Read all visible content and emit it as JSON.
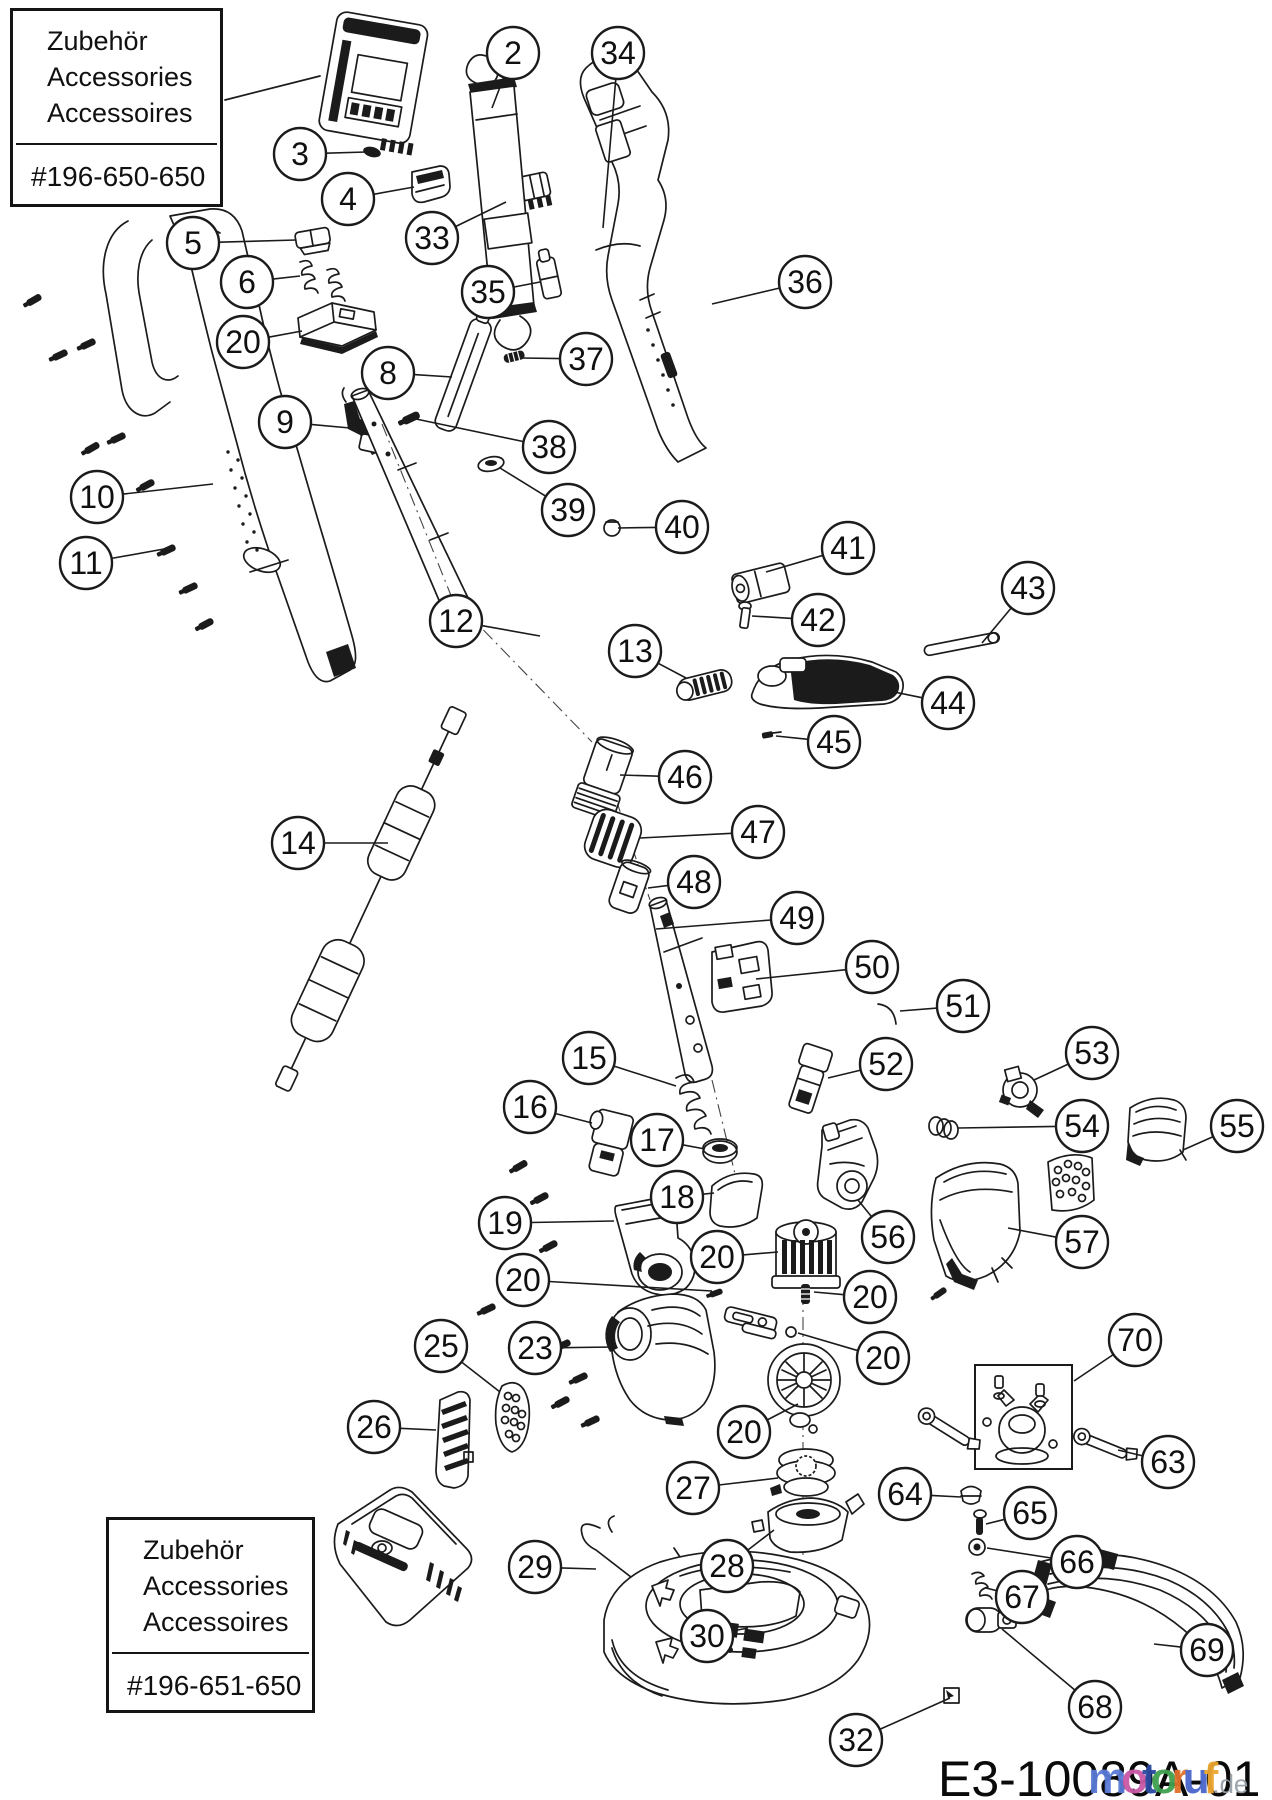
{
  "page": {
    "background": "#ffffff",
    "ink": "#1b1b1b"
  },
  "accessory_boxes": [
    {
      "lines": [
        "Zubehör",
        "Accessories",
        "Accessoires"
      ],
      "part_number": "#196-650-650"
    },
    {
      "lines": [
        "Zubehör",
        "Accessories",
        "Accessoires"
      ],
      "part_number": "#196-651-650"
    }
  ],
  "footer": {
    "drawing_number": "E3-10089A-01"
  },
  "watermark": {
    "suffix": ".de",
    "letters": [
      {
        "ch": "m",
        "color": "#5a7bd8"
      },
      {
        "ch": "o",
        "color": "#c957a5"
      },
      {
        "ch": "t",
        "color": "#2b4aa0"
      },
      {
        "ch": "o",
        "color": "#3fa04f"
      },
      {
        "ch": "r",
        "color": "#e2702a"
      },
      {
        "ch": "u",
        "color": "#4a66cc"
      },
      {
        "ch": "f",
        "color": "#eda52f"
      }
    ]
  },
  "callouts": [
    {
      "n": "2",
      "x": 513,
      "y": 53,
      "tx": 492,
      "ty": 108
    },
    {
      "n": "34",
      "x": 618,
      "y": 53,
      "tx": 603,
      "ty": 228
    },
    {
      "n": "3",
      "x": 300,
      "y": 154,
      "tx": 366,
      "ty": 152
    },
    {
      "n": "4",
      "x": 348,
      "y": 199,
      "tx": 414,
      "ty": 187
    },
    {
      "n": "33",
      "x": 432,
      "y": 238,
      "tx": 506,
      "ty": 202
    },
    {
      "n": "5",
      "x": 193,
      "y": 243,
      "tx": 296,
      "ty": 240
    },
    {
      "n": "6",
      "x": 247,
      "y": 282,
      "tx": 300,
      "ty": 276
    },
    {
      "n": "35",
      "x": 488,
      "y": 292,
      "tx": 540,
      "ty": 282
    },
    {
      "n": "36",
      "x": 805,
      "y": 282,
      "tx": 712,
      "ty": 304
    },
    {
      "n": "20",
      "x": 243,
      "y": 342,
      "tx": 302,
      "ty": 331
    },
    {
      "n": "8",
      "x": 388,
      "y": 373,
      "tx": 452,
      "ty": 377
    },
    {
      "n": "37",
      "x": 586,
      "y": 359,
      "tx": 522,
      "ty": 358
    },
    {
      "n": "9",
      "x": 285,
      "y": 422,
      "tx": 350,
      "ty": 428
    },
    {
      "n": "38",
      "x": 549,
      "y": 447,
      "tx": 416,
      "ty": 419
    },
    {
      "n": "10",
      "x": 97,
      "y": 497,
      "tx": 213,
      "ty": 484
    },
    {
      "n": "39",
      "x": 568,
      "y": 510,
      "tx": 500,
      "ty": 468
    },
    {
      "n": "40",
      "x": 682,
      "y": 527,
      "tx": 618,
      "ty": 528
    },
    {
      "n": "11",
      "x": 86,
      "y": 563,
      "tx": 164,
      "ty": 549
    },
    {
      "n": "41",
      "x": 848,
      "y": 548,
      "tx": 766,
      "ty": 572
    },
    {
      "n": "43",
      "x": 1028,
      "y": 588,
      "tx": 982,
      "ty": 643
    },
    {
      "n": "12",
      "x": 456,
      "y": 621,
      "tx": 540,
      "ty": 636
    },
    {
      "n": "42",
      "x": 818,
      "y": 620,
      "tx": 752,
      "ty": 616
    },
    {
      "n": "13",
      "x": 635,
      "y": 651,
      "tx": 686,
      "ty": 678
    },
    {
      "n": "44",
      "x": 948,
      "y": 703,
      "tx": 870,
      "ty": 687
    },
    {
      "n": "45",
      "x": 834,
      "y": 742,
      "tx": 776,
      "ty": 736
    },
    {
      "n": "46",
      "x": 685,
      "y": 777,
      "tx": 620,
      "ty": 775
    },
    {
      "n": "14",
      "x": 298,
      "y": 843,
      "tx": 388,
      "ty": 843
    },
    {
      "n": "47",
      "x": 758,
      "y": 832,
      "tx": 640,
      "ty": 838
    },
    {
      "n": "48",
      "x": 694,
      "y": 882,
      "tx": 648,
      "ty": 888
    },
    {
      "n": "49",
      "x": 797,
      "y": 918,
      "tx": 656,
      "ty": 929
    },
    {
      "n": "50",
      "x": 872,
      "y": 967,
      "tx": 756,
      "ty": 979
    },
    {
      "n": "51",
      "x": 963,
      "y": 1006,
      "tx": 900,
      "ty": 1011
    },
    {
      "n": "53",
      "x": 1092,
      "y": 1053,
      "tx": 1034,
      "ty": 1080
    },
    {
      "n": "15",
      "x": 589,
      "y": 1058,
      "tx": 676,
      "ty": 1086
    },
    {
      "n": "52",
      "x": 886,
      "y": 1064,
      "tx": 828,
      "ty": 1078
    },
    {
      "n": "16",
      "x": 530,
      "y": 1107,
      "tx": 592,
      "ty": 1123
    },
    {
      "n": "54",
      "x": 1082,
      "y": 1126,
      "tx": 958,
      "ty": 1128
    },
    {
      "n": "55",
      "x": 1237,
      "y": 1126,
      "tx": 1183,
      "ty": 1150
    },
    {
      "n": "17",
      "x": 657,
      "y": 1140,
      "tx": 705,
      "ty": 1149
    },
    {
      "n": "18",
      "x": 677,
      "y": 1197,
      "tx": 714,
      "ty": 1193
    },
    {
      "n": "19",
      "x": 505,
      "y": 1223,
      "tx": 614,
      "ty": 1221
    },
    {
      "n": "56",
      "x": 888,
      "y": 1237,
      "tx": 858,
      "ty": 1200
    },
    {
      "n": "57",
      "x": 1082,
      "y": 1242,
      "tx": 1008,
      "ty": 1228
    },
    {
      "n": "20",
      "x": 717,
      "y": 1257,
      "tx": 778,
      "ty": 1252
    },
    {
      "n": "20",
      "x": 523,
      "y": 1280,
      "tx": 712,
      "ty": 1291
    },
    {
      "n": "20",
      "x": 870,
      "y": 1297,
      "tx": 814,
      "ty": 1292
    },
    {
      "n": "70",
      "x": 1135,
      "y": 1340,
      "tx": 1074,
      "ty": 1381
    },
    {
      "n": "25",
      "x": 441,
      "y": 1346,
      "tx": 500,
      "ty": 1392
    },
    {
      "n": "23",
      "x": 535,
      "y": 1348,
      "tx": 614,
      "ty": 1347
    },
    {
      "n": "20",
      "x": 883,
      "y": 1358,
      "tx": 798,
      "ty": 1333
    },
    {
      "n": "26",
      "x": 374,
      "y": 1427,
      "tx": 436,
      "ty": 1430
    },
    {
      "n": "20",
      "x": 744,
      "y": 1432,
      "tx": 798,
      "ty": 1404
    },
    {
      "n": "63",
      "x": 1168,
      "y": 1462,
      "tx": 1118,
      "ty": 1450
    },
    {
      "n": "27",
      "x": 693,
      "y": 1488,
      "tx": 778,
      "ty": 1478
    },
    {
      "n": "64",
      "x": 905,
      "y": 1494,
      "tx": 961,
      "ty": 1497
    },
    {
      "n": "65",
      "x": 1030,
      "y": 1513,
      "tx": 986,
      "ty": 1524
    },
    {
      "n": "66",
      "x": 1077,
      "y": 1562,
      "tx": 987,
      "ty": 1548
    },
    {
      "n": "29",
      "x": 535,
      "y": 1567,
      "tx": 596,
      "ty": 1569
    },
    {
      "n": "28",
      "x": 727,
      "y": 1566,
      "tx": 774,
      "ty": 1530
    },
    {
      "n": "67",
      "x": 1022,
      "y": 1597,
      "tx": 986,
      "ty": 1588
    },
    {
      "n": "30",
      "x": 707,
      "y": 1636,
      "tx": 748,
      "ty": 1628
    },
    {
      "n": "69",
      "x": 1207,
      "y": 1650,
      "tx": 1154,
      "ty": 1644
    },
    {
      "n": "68",
      "x": 1095,
      "y": 1707,
      "tx": 1002,
      "ty": 1629
    },
    {
      "n": "32",
      "x": 856,
      "y": 1740,
      "tx": 950,
      "ty": 1698
    }
  ]
}
